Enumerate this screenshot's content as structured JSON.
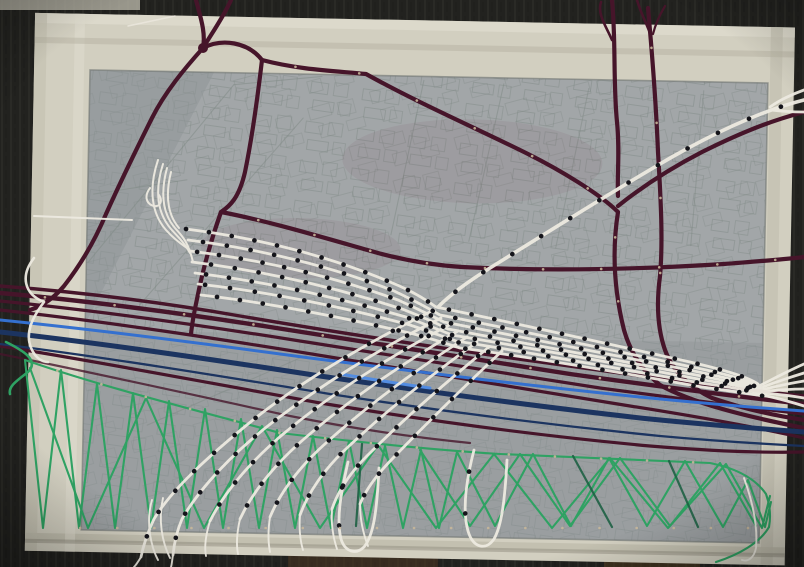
{
  "scene": {
    "kind": "string-art-map-photograph",
    "board": {
      "backdrop": "#22221f",
      "backdrop_grain": "#31312d",
      "tape": "#d2cfc0",
      "tape_light": "#e2dfd2",
      "tape_shadow": "#aaa796",
      "paper": "#a2a6a8",
      "paper_shade": "#8e9396",
      "sketch": "#7f8a85"
    },
    "threads": {
      "road": "#46152a",
      "road_dark": "#380f20",
      "rail": "#edeae0",
      "river_bright": "#3470cf",
      "river_dark": "#1c3460",
      "green": "#2fa263",
      "green_dark": "#1e6044",
      "pin": "#14141a",
      "pin_brass": "#c8b79a"
    }
  }
}
